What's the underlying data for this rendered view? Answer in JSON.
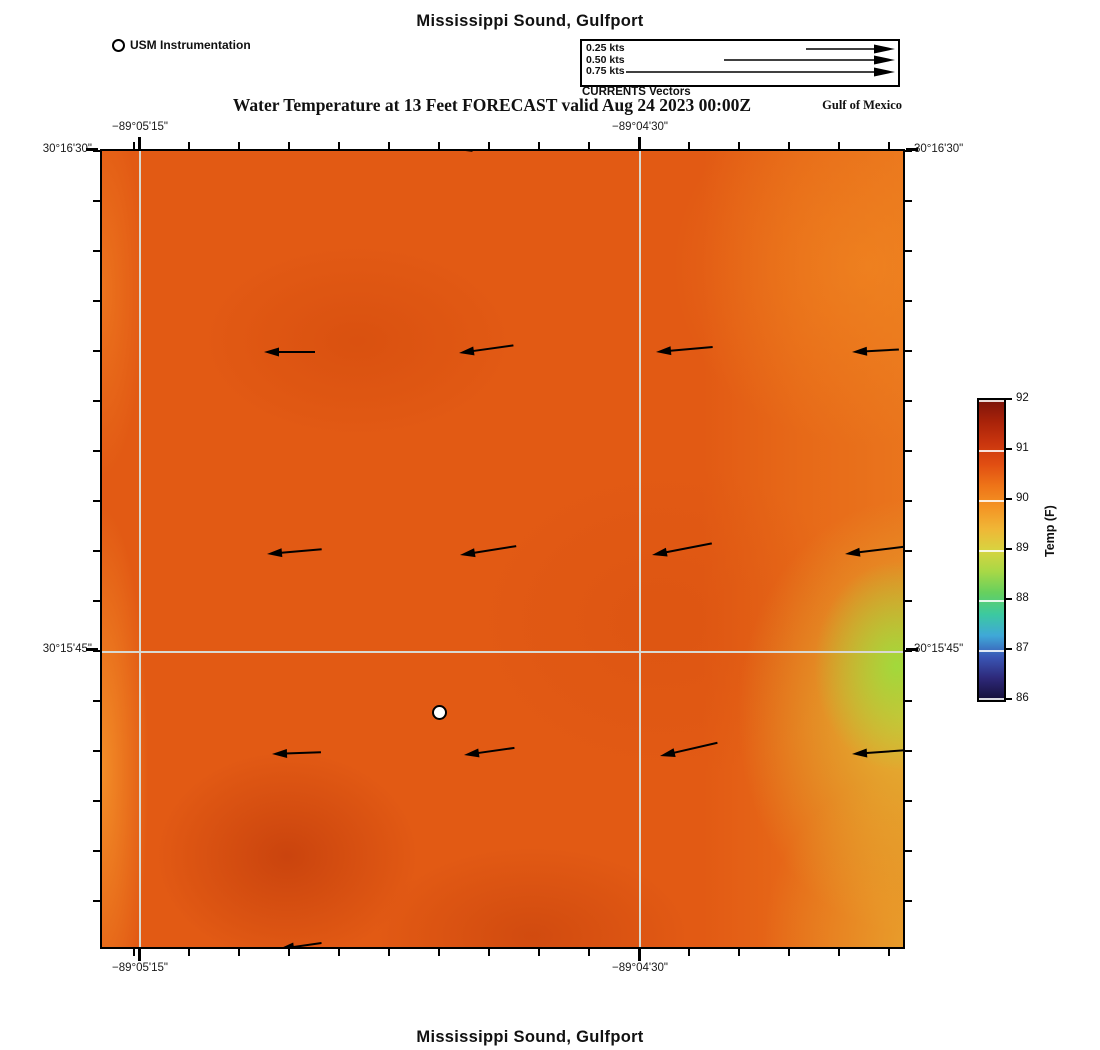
{
  "header": {
    "title": "Mississippi Sound, Gulfport",
    "usm_label": "USM Instrumentation",
    "vector_legend": {
      "rows": [
        {
          "label": "0.25 kts",
          "line_from": 222
        },
        {
          "label": "0.50 kts",
          "line_from": 140
        },
        {
          "label": "0.75 kts",
          "line_from": 42
        }
      ],
      "caption": "CURRENTS Vectors"
    },
    "subtitle": "Water Temperature at 13 Feet FORECAST valid Aug 24 2023 00:00Z",
    "region_label": "Gulf of Mexico"
  },
  "axes": {
    "top": {
      "x1": "−89°05'15\"",
      "x2": "−89°04'30\""
    },
    "bottom": {
      "x1": "−89°05'15\"",
      "x2": "−89°04'30\""
    },
    "left": {
      "y1": "30°16'30\"",
      "y2": "30°15'45\""
    },
    "right": {
      "y1": "30°16'30\"",
      "y2": "30°15'45\""
    }
  },
  "colorbar": {
    "label": "Temp (F)",
    "ticks": [
      "92",
      "91",
      "90",
      "89",
      "88",
      "87",
      "86"
    ],
    "gradient_top_to_bottom": [
      "#7c140b",
      "#a82209",
      "#c9350e",
      "#e14e12",
      "#ee7418",
      "#f49424",
      "#f0b636",
      "#d8d340",
      "#a8d846",
      "#66d05e",
      "#3cc9a0",
      "#3fa8d8",
      "#3a55b4",
      "#2d2878",
      "#150f38"
    ]
  },
  "footer": {
    "title": "Mississippi Sound, Gulfport"
  },
  "chart_data": {
    "type": "heatmap",
    "title": "Mississippi Sound, Gulfport",
    "subtitle": "Water Temperature at 13 Feet FORECAST valid Aug 24 2023 00:00Z",
    "colorbar_label": "Temp (F)",
    "colorbar_range": [
      86,
      92
    ],
    "colorbar_tick_values": [
      86,
      87,
      88,
      89,
      90,
      91,
      92
    ],
    "x_tick_labels": [
      "−89°05'15\"",
      "−89°04'30\""
    ],
    "y_tick_labels": [
      "30°16'30\"",
      "30°15'45\""
    ],
    "temperature_field_estimate_F": {
      "dominant": 90.5,
      "warm_patches_lower_left_and_bottom": 91,
      "cool_patch_right_edge": 89,
      "notes": "Mostly orange 90–91 F; yellow-green ~89 F band along the east (right) edge near 30°15'45\"; slightly darker ~91 F patches in lower-left and bottom-center; lighter ~90 F along west edge and northeast corner."
    },
    "currents": {
      "direction": "westward",
      "legend_speeds_kts": [
        0.25,
        0.5,
        0.75
      ],
      "vectors_px": [
        {
          "x": 162,
          "y": 201,
          "len": 36,
          "tilt": 0
        },
        {
          "x": 357,
          "y": 202,
          "len": 40,
          "tilt": -8
        },
        {
          "x": 554,
          "y": 201,
          "len": 42,
          "tilt": -5
        },
        {
          "x": 750,
          "y": 201,
          "len": 32,
          "tilt": -3
        },
        {
          "x": 165,
          "y": 403,
          "len": 40,
          "tilt": -5
        },
        {
          "x": 358,
          "y": 404,
          "len": 42,
          "tilt": -9
        },
        {
          "x": 550,
          "y": 404,
          "len": 46,
          "tilt": -11
        },
        {
          "x": 743,
          "y": 403,
          "len": 48,
          "tilt": -7
        },
        {
          "x": 170,
          "y": 603,
          "len": 34,
          "tilt": -2
        },
        {
          "x": 362,
          "y": 604,
          "len": 36,
          "tilt": -8
        },
        {
          "x": 558,
          "y": 605,
          "len": 44,
          "tilt": -13
        },
        {
          "x": 750,
          "y": 603,
          "len": 40,
          "tilt": -4
        },
        {
          "x": 355,
          "y": -1,
          "len": 28,
          "tilt": -10
        },
        {
          "x": 177,
          "y": 798,
          "len": 28,
          "tilt": -8
        }
      ]
    },
    "station": {
      "name": "USM Instrumentation",
      "px": [
        337,
        561
      ]
    }
  }
}
